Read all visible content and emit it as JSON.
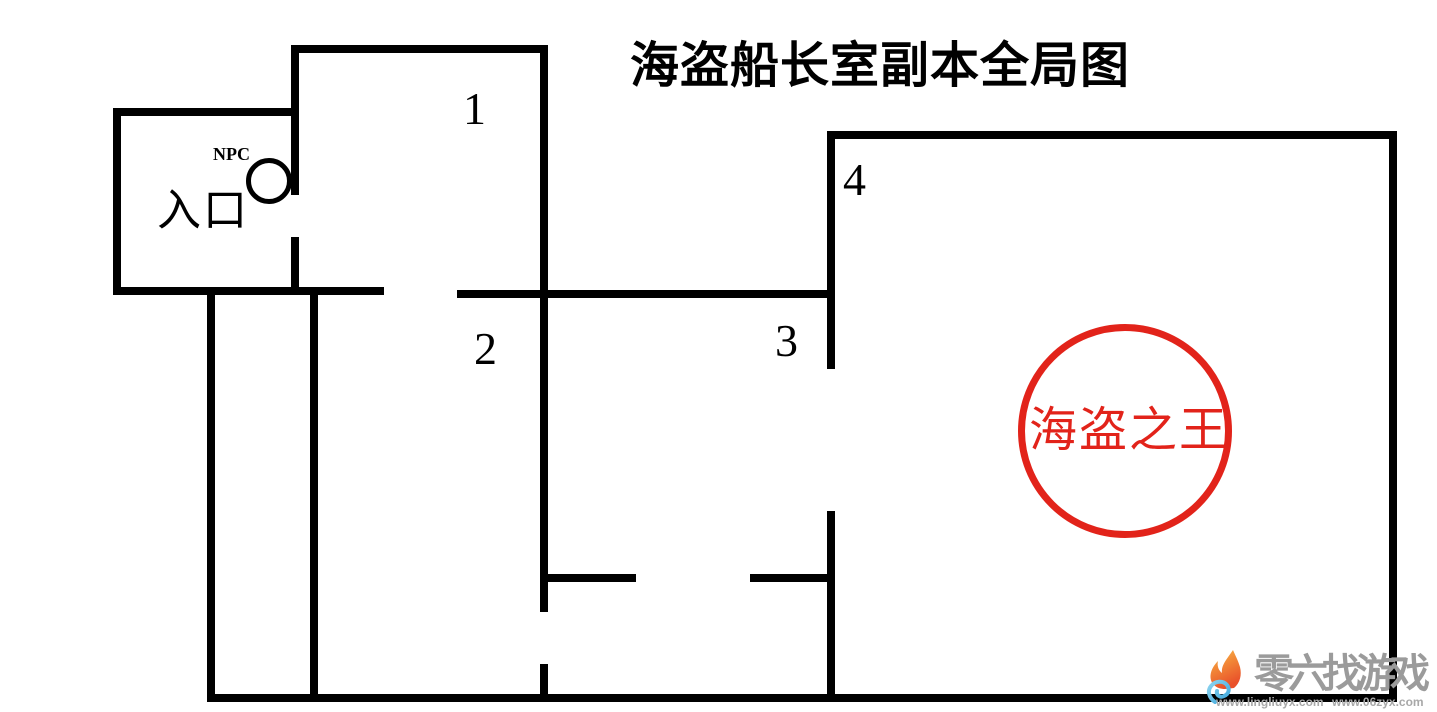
{
  "title": "海盗船长室副本全局图",
  "map": {
    "entrance_label": "入口",
    "npc_label": "NPC",
    "room1_label": "1",
    "room2_label": "2",
    "room3_label": "3",
    "room4_label": "4",
    "boss_label": "海盗之王"
  },
  "colors": {
    "wall": "#000000",
    "background": "#ffffff",
    "boss_red": "#e2231a",
    "watermark_gray": "#9b9b9b"
  },
  "watermark": {
    "logo_icon": "flame-swirl-icon",
    "site_name": "零六找游戏",
    "url_left": "www.lingliuyx.com",
    "url_right": "www.06zyx.com"
  }
}
